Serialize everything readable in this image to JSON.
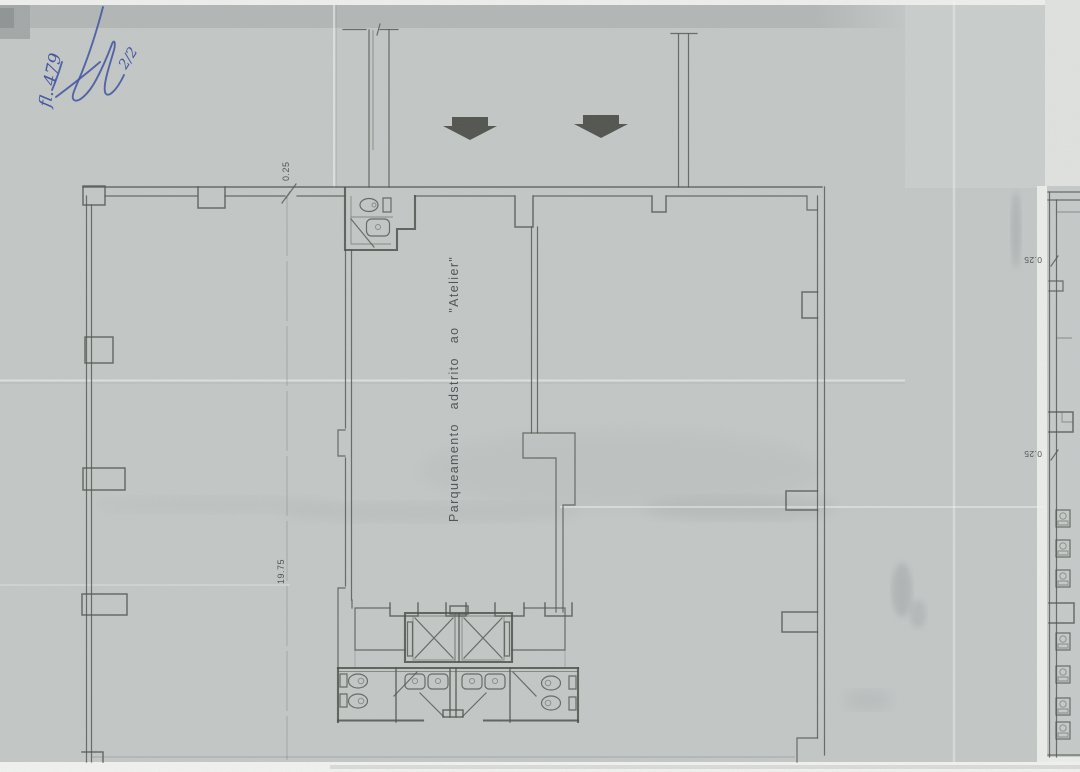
{
  "annotations": {
    "folio": "fl. 479",
    "sheet": "2/2"
  },
  "plan": {
    "area_label": "Parqueamento adstrito ao \"Atelier\"",
    "dimensions": {
      "top_wall": "0.25",
      "left_length": "19.75",
      "right_upper": "0.25",
      "right_lower": "0.25"
    }
  },
  "icons": {
    "entrance_arrows": "block-arrow-down",
    "toilet": "toilet-plan-icon",
    "sink": "sink-plan-icon",
    "elevator": "elevator-x-shaft-icon",
    "door": "door-swing-line"
  },
  "colors": {
    "paper": "#c5c9c8",
    "line": "#4f524c",
    "pen_blue": "#3c50a0",
    "arrow": "#3f403a"
  }
}
